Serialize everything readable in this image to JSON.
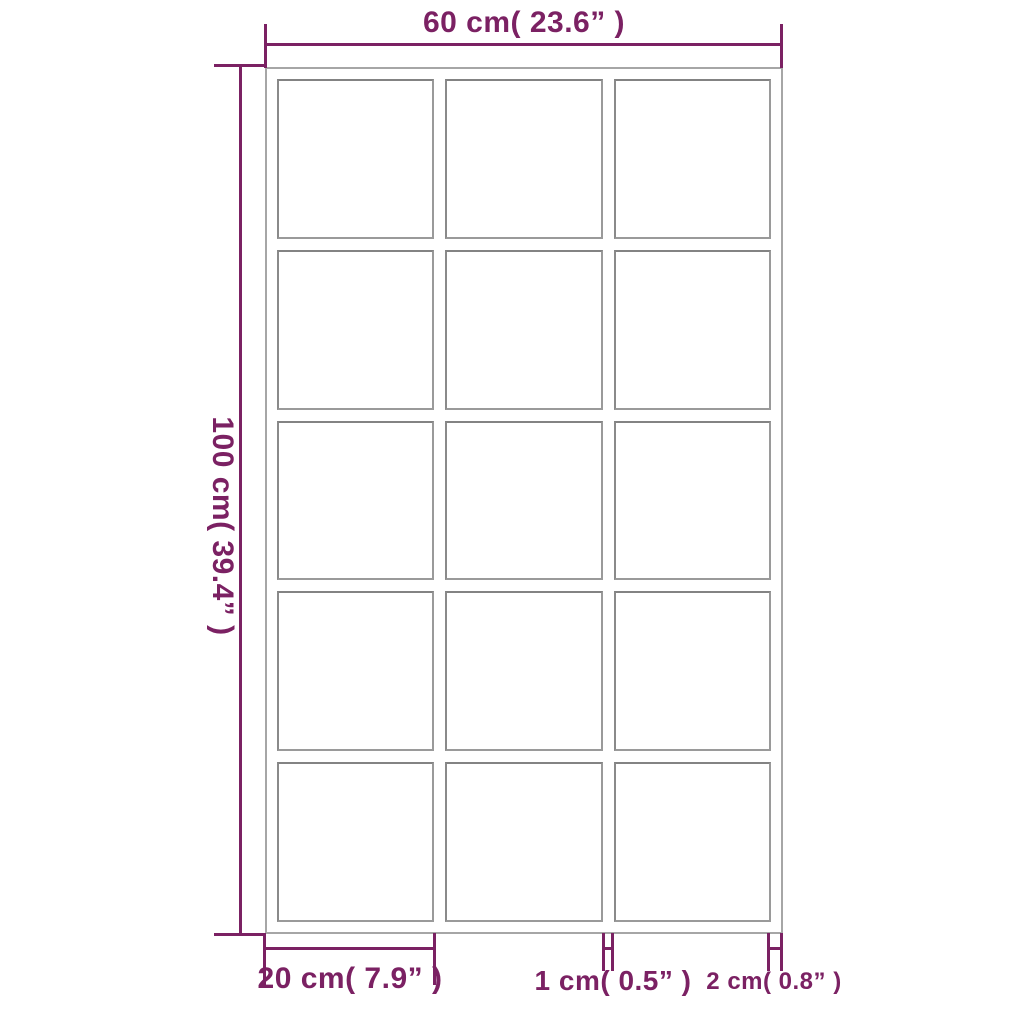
{
  "mirror": {
    "description": "wall mirror dimension diagram",
    "grid": {
      "columns": 3,
      "rows": 5,
      "pane_count": 15
    },
    "colors": {
      "accent": "#7B2163",
      "frame_outer": "#A6A6A6",
      "pane_border": "#8F8F8F",
      "background": "#FFFFFF"
    },
    "annotations": {
      "width": {
        "label": "60 cm( 23.6” )"
      },
      "height": {
        "label": "100 cm( 39.4” )"
      },
      "pane_width": {
        "label": "20 cm( 7.9” )"
      },
      "mullion_width": {
        "label": "1 cm( 0.5” )"
      },
      "frame_width": {
        "label": "2 cm( 0.8” )"
      }
    }
  }
}
